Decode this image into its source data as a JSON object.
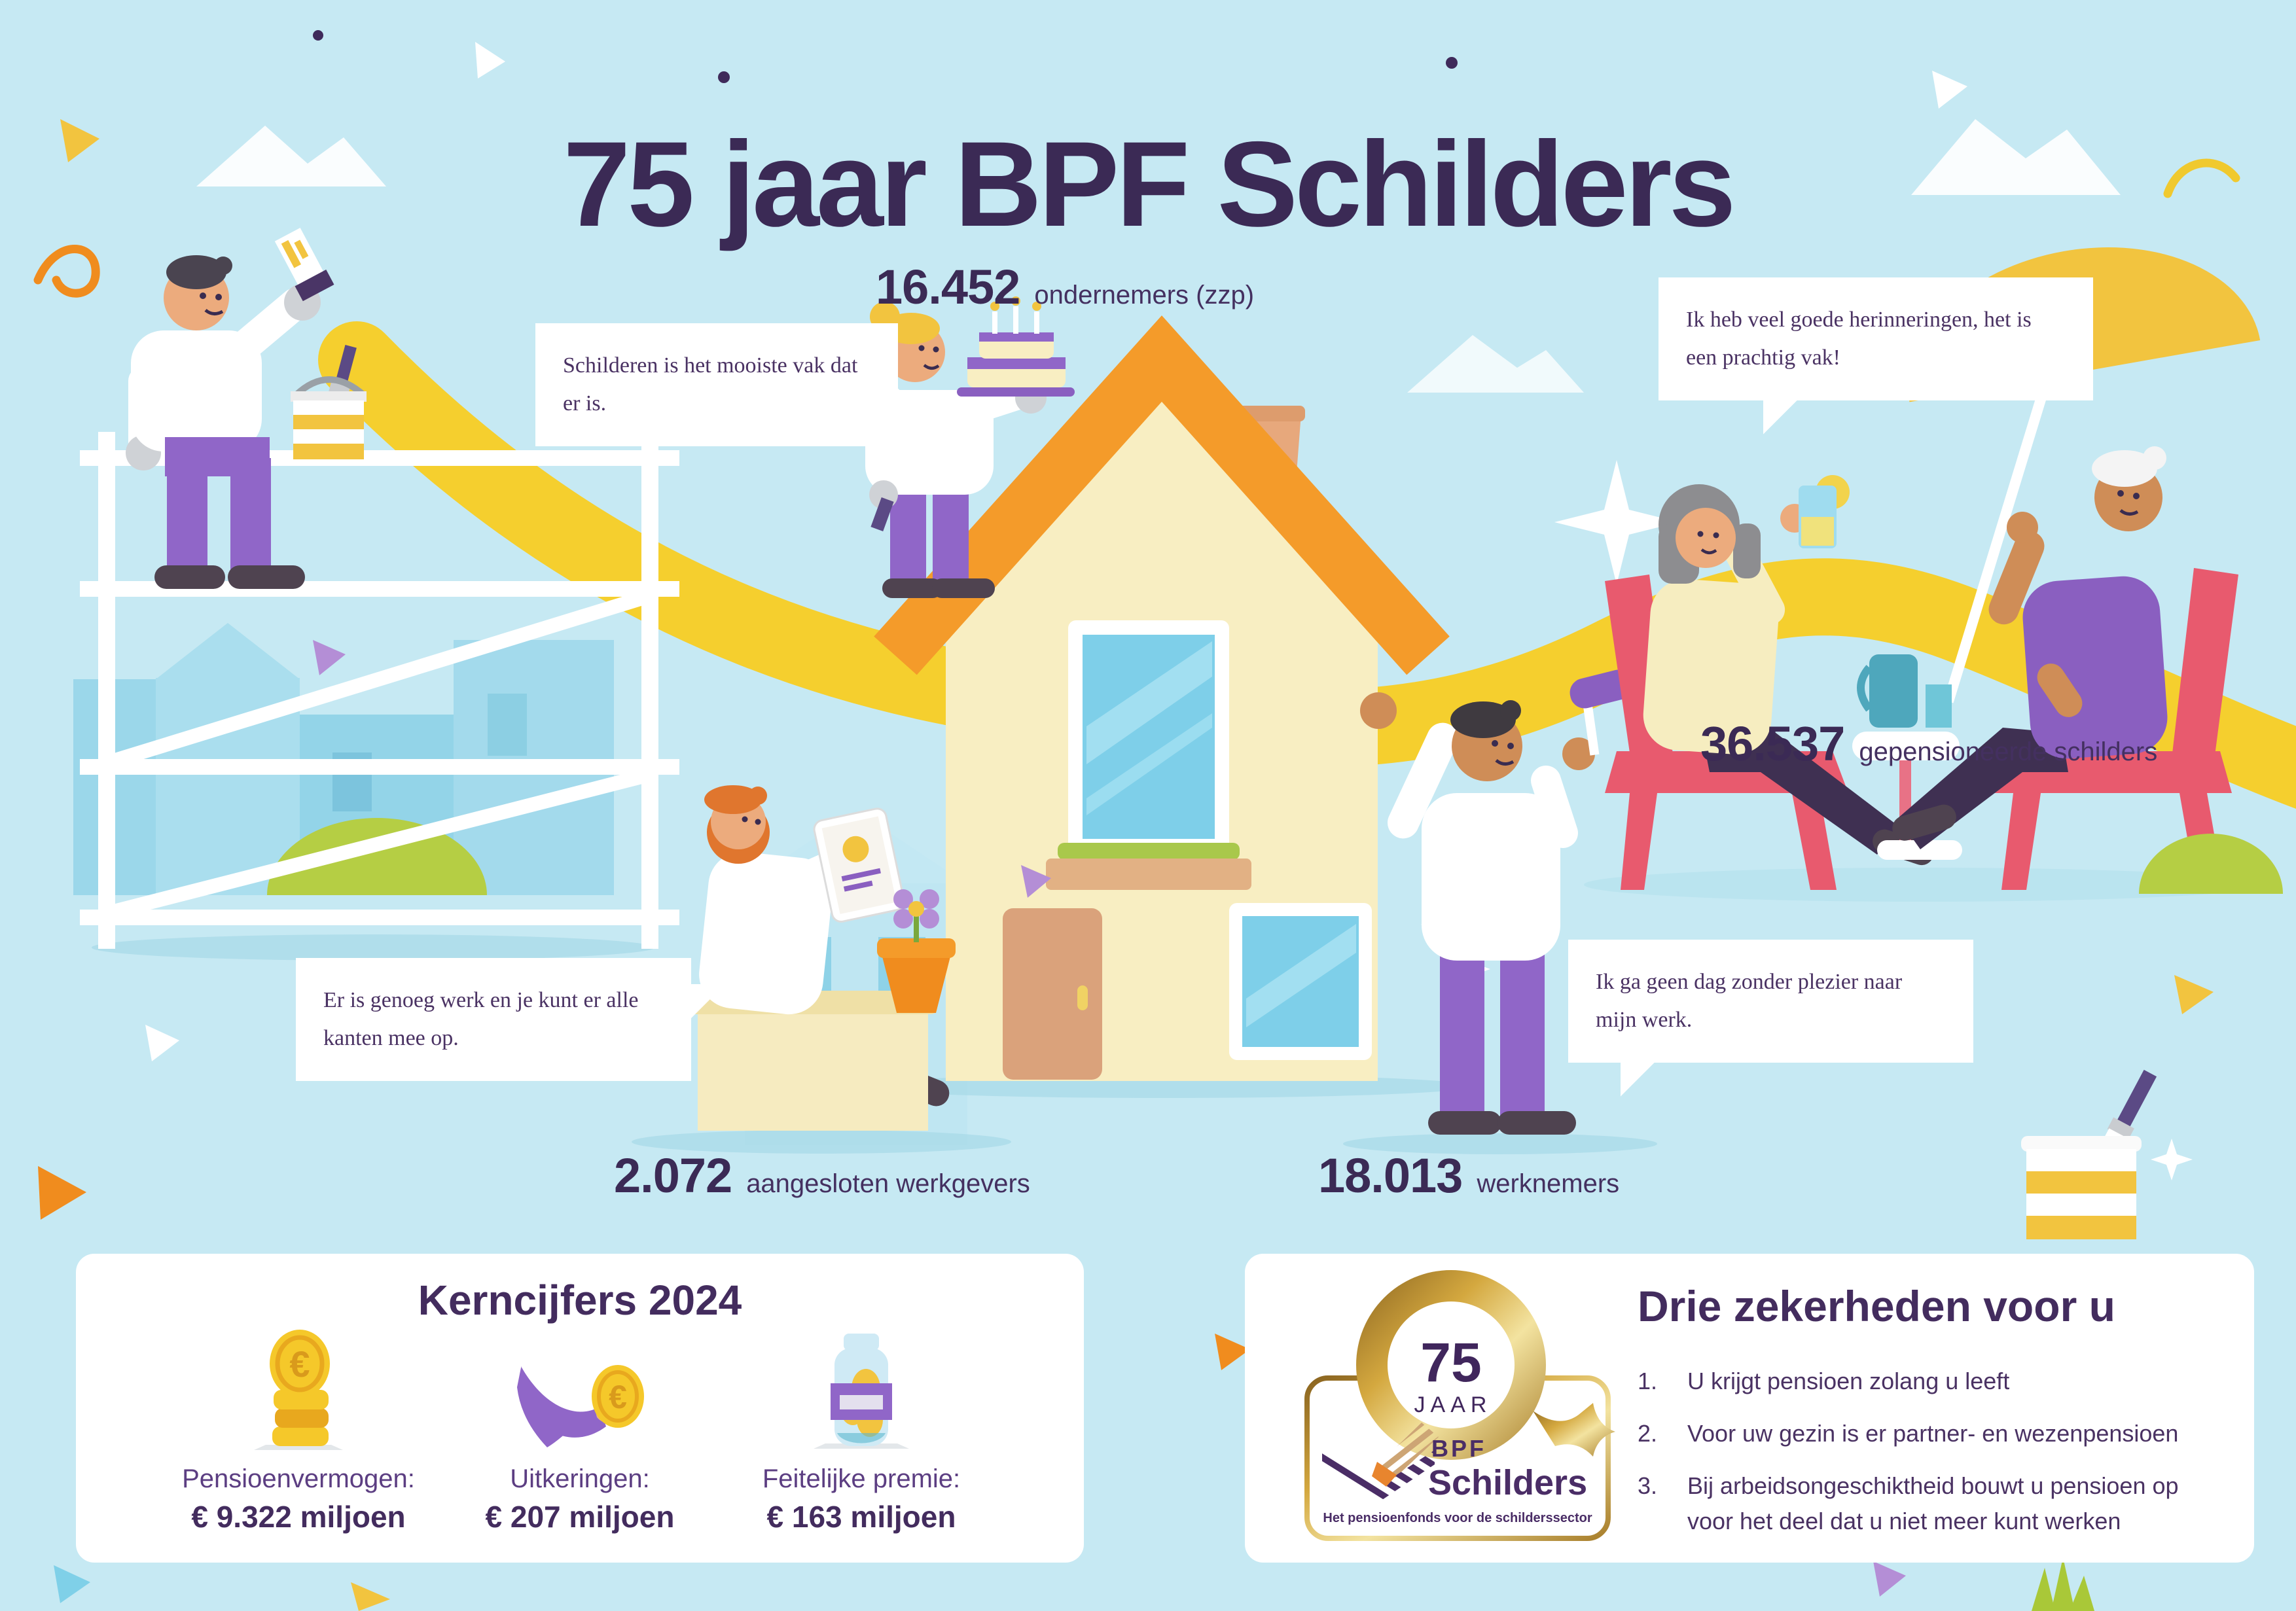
{
  "title": "75 jaar BPF Schilders",
  "stats": {
    "ondernemers": {
      "value": "16.452",
      "label": "ondernemers (zzp)"
    },
    "werkgevers": {
      "value": "2.072",
      "label": "aangesloten werkgevers"
    },
    "werknemers": {
      "value": "18.013",
      "label": "werknemers"
    },
    "gepensioneerden": {
      "value": "36.537",
      "label": "gepensioneerde schilders"
    }
  },
  "bubbles": {
    "painter": "Schilderen is het mooiste vak dat er is.",
    "zzp": "Er is genoeg werk en je kunt er alle kanten mee op.",
    "werknemer": "Ik ga geen dag zonder plezier naar mijn werk.",
    "gepensioneerde": "Ik heb veel goede herinneringen, het is een prachtig vak!"
  },
  "kerncijfers": {
    "title": "Kerncijfers 2024",
    "euro": "€",
    "items": [
      {
        "label": "Pensioenvermogen:",
        "value": "€ 9.322 miljoen"
      },
      {
        "label": "Uitkeringen:",
        "value": "€ 207 miljoen"
      },
      {
        "label": "Feitelijke premie:",
        "value": "€ 163 miljoen"
      }
    ]
  },
  "zekerheden": {
    "title": "Drie zekerheden voor u",
    "items": [
      {
        "num": "1.",
        "text": "U krijgt pensioen zolang u leeft"
      },
      {
        "num": "2.",
        "text": "Voor uw gezin is er partner- en wezenpensioen"
      },
      {
        "num": "3.",
        "text": "Bij arbeidsongeschiktheid bouwt u pensioen op voor het deel dat u niet meer kunt werken"
      }
    ]
  },
  "logo": {
    "badge_number": "75",
    "badge_label": "JAAR",
    "brand_prefix": "BPF",
    "brand_name": "Schilders",
    "tagline": "Het pensioenfonds voor de schilderssector"
  },
  "colors": {
    "background": "#c6e9f3",
    "ink": "#432c5e",
    "yellow": "#f5cf2e",
    "orange": "#f49b2a",
    "purple": "#9066c8",
    "chair_red": "#e85a6e",
    "gold": "#c9a23f"
  }
}
